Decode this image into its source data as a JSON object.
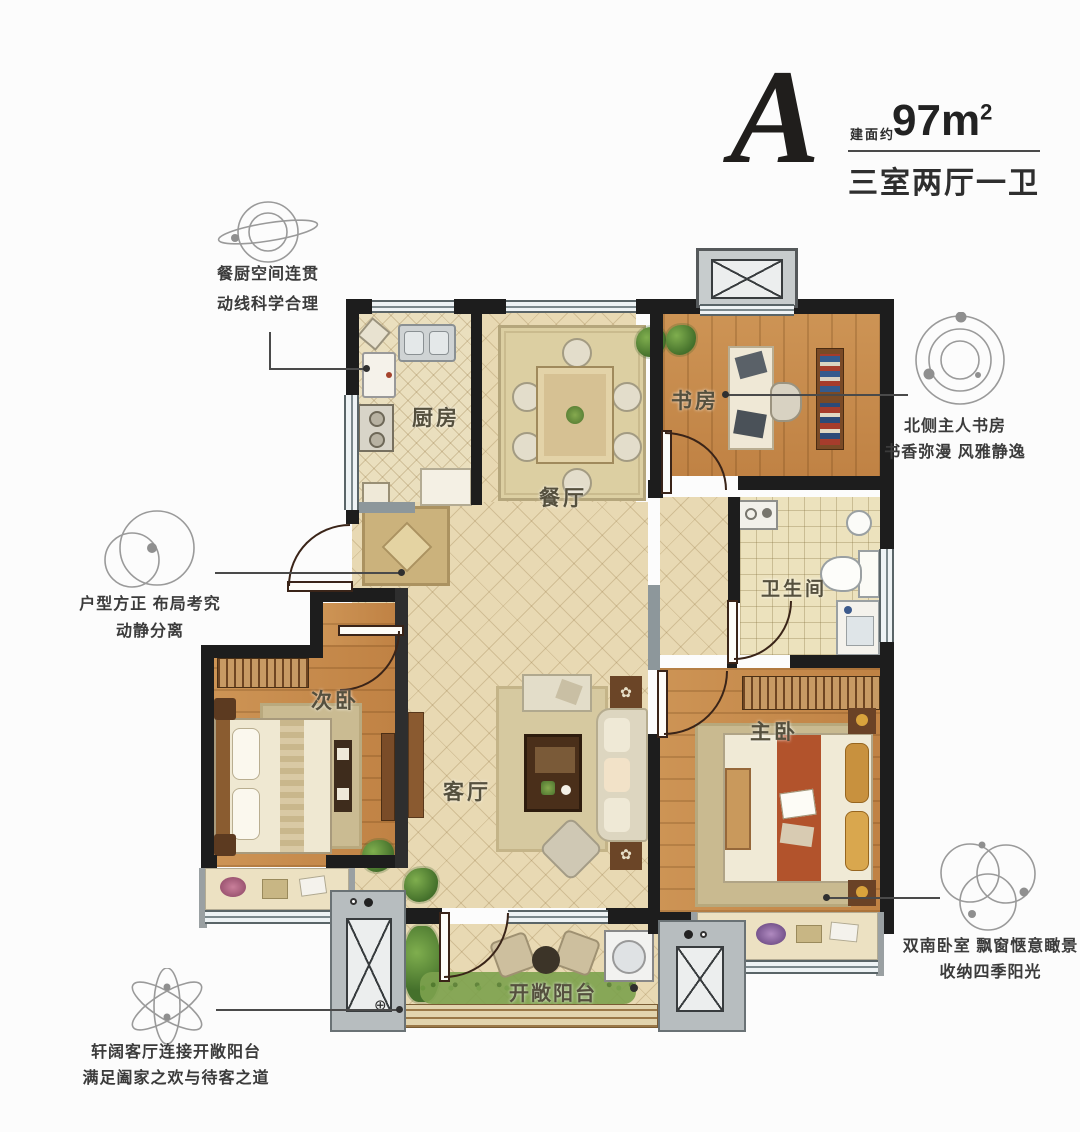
{
  "header": {
    "unit": "A",
    "area_label": "建面约",
    "area_value": "97m",
    "area_sup": "2",
    "layout_desc": "三室两厅一卫"
  },
  "rooms": {
    "kitchen": "厨房",
    "dining": "餐厅",
    "study": "书房",
    "bathroom": "卫生间",
    "second_bedroom": "次卧",
    "living": "客厅",
    "master_bedroom": "主卧",
    "balcony": "开敞阳台"
  },
  "callouts": {
    "kitchen_dining": {
      "icon": "saturn-orbit-icon",
      "line1": "餐厨空间连贯",
      "line2": "动线科学合理"
    },
    "layout": {
      "icon": "overlapping-circles-icon",
      "line1": "户型方正 布局考究",
      "line2": "动静分离"
    },
    "study": {
      "icon": "concentric-orbits-icon",
      "line1": "北侧主人书房",
      "line2": "书香弥漫 风雅静逸"
    },
    "south_bedrooms": {
      "icon": "triple-circles-icon",
      "line1": "双南卧室 飘窗惬意瞰景",
      "line2": "收纳四季阳光"
    },
    "living_balcony": {
      "icon": "atom-orbits-icon",
      "line1": "轩阔客厅连接开敞阳台",
      "line2": "满足阖家之欢与待客之道"
    }
  },
  "colors": {
    "wall": "#1d1d1d",
    "wood_floor": "#c78e4e",
    "tile_floor": "#e8d9b3",
    "bathroom_tile": "#ece2bd",
    "window": "#eef3f5",
    "platform_gray": "#b7bdbf",
    "bed_runner_red": "#b2532c",
    "rug": "#d6c9a0",
    "text_dark": "#3a3a3a",
    "leader_line": "#4a4a4a"
  }
}
